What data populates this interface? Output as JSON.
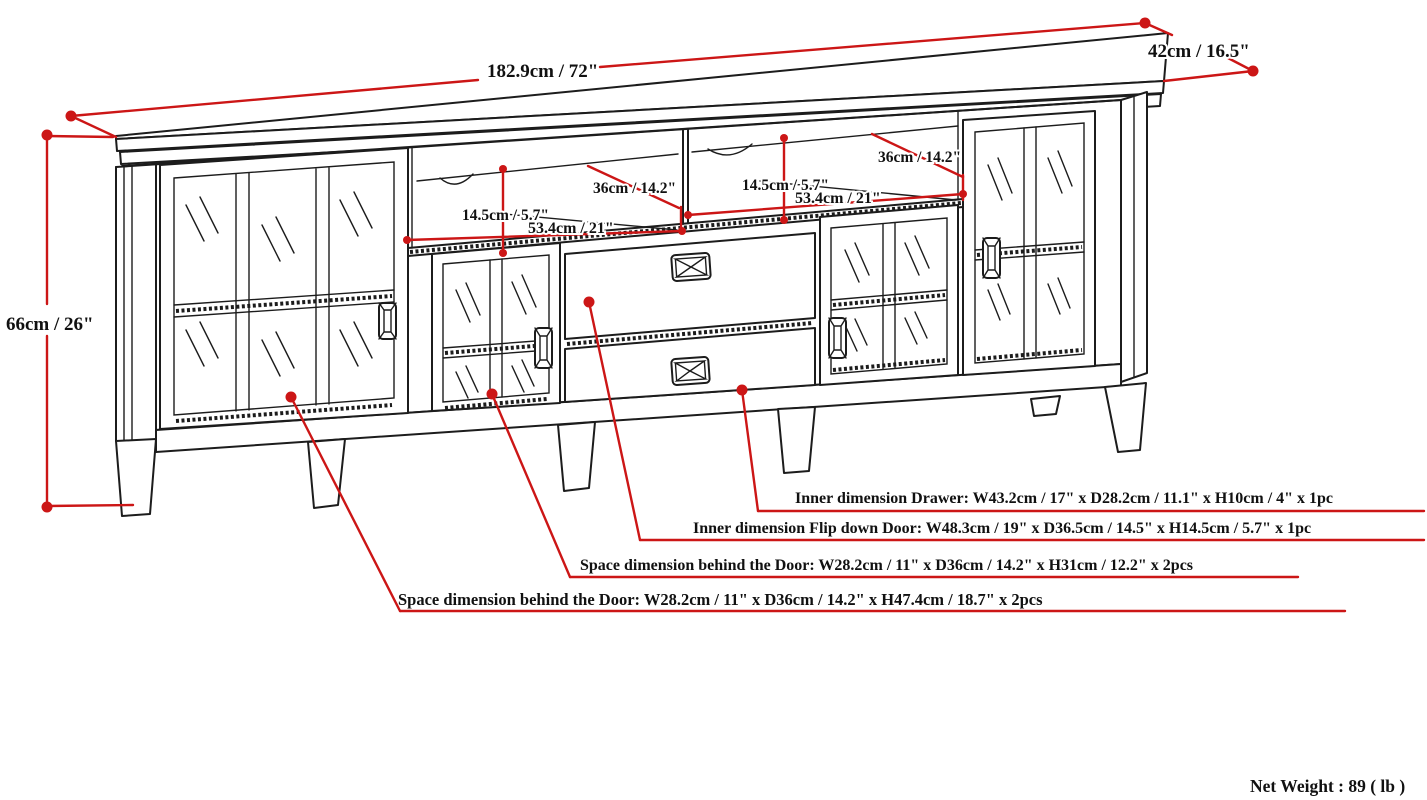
{
  "diagram": {
    "title_note": "Net Weight : 89 ( lb )",
    "colors": {
      "dimension_line": "#cc1616",
      "drawing_line": "#1c1c1c",
      "background": "#ffffff"
    },
    "overall": {
      "width": "182.9cm / 72\"",
      "depth": "42cm / 16.5\"",
      "height": "66cm / 26\""
    },
    "left_compartment": {
      "height": "14.5cm / 5.7\"",
      "width": "53.4cm / 21\"",
      "depth": "36cm / 14.2\""
    },
    "right_compartment": {
      "height": "14.5cm / 5.7\"",
      "width": "53.4cm / 21\"",
      "depth": "36cm / 14.2\""
    },
    "annotations": [
      "Inner dimension Drawer: W43.2cm / 17\" x D28.2cm / 11.1\" x H10cm / 4\" x 1pc",
      "Inner dimension Flip down Door: W48.3cm / 19\" x D36.5cm / 14.5\" x H14.5cm / 5.7\" x 1pc",
      "Space dimension behind the Door: W28.2cm / 11\" x D36cm / 14.2\" x H31cm / 12.2\" x 2pcs",
      "Space dimension behind the Door:  W28.2cm / 11\" x D36cm / 14.2\" x H47.4cm / 18.7\" x 2pcs"
    ]
  }
}
